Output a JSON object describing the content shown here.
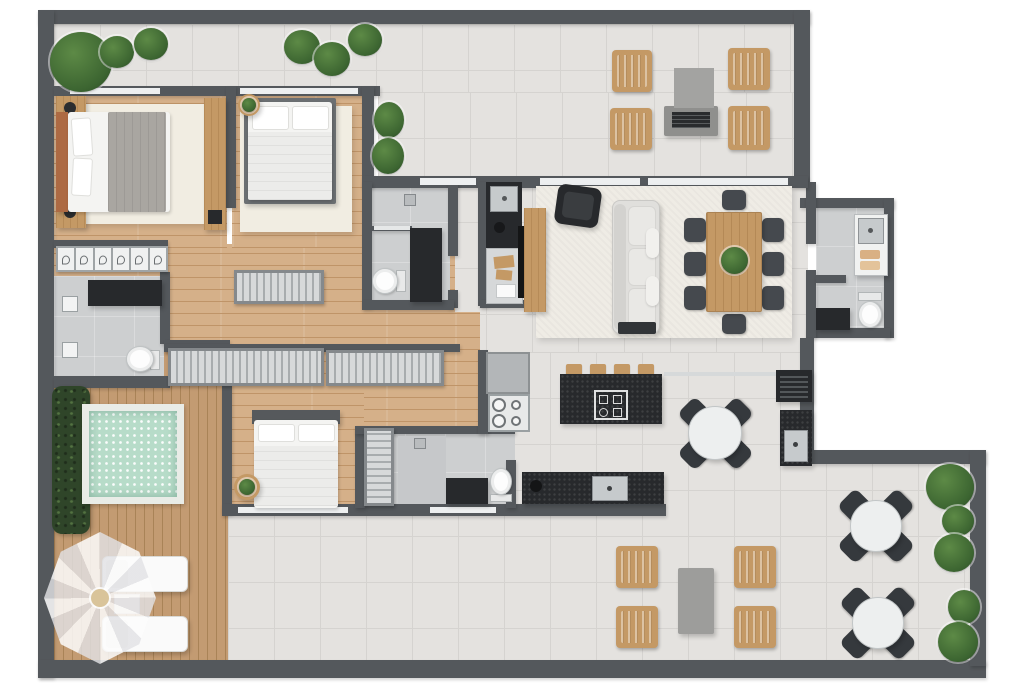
{
  "title": "apartment-floor-plan-top-view",
  "palette": {
    "outside": "#ffffff",
    "wall": "#54585c",
    "tile": "#e4e2df",
    "tile_line": "#d5d3d0",
    "bath_tile": "#cdcfd0",
    "wood": "#d5b089",
    "wood_line": "#bf9468",
    "deck": "#c39b72",
    "deck_line": "#a98357",
    "rug": "#f1ede2",
    "rug_living": "#efece5",
    "furn_dark": "#27292c",
    "wood_furn": "#c49965",
    "chair_dark": "#45494e",
    "sofa": "#e0dfdc",
    "sofa_base": "#323538",
    "steel": "#c6cacc",
    "glass": "#edeff0",
    "pool": "#b7dcc9",
    "hedge": "#2f4529",
    "plant": "#3c6531",
    "plant_light": "#5d8a46",
    "fire_table": "#a3a3a1",
    "fire_base": "#8f8f8d",
    "towel": "#d9b084",
    "headboard": "#ad6a43",
    "blanket": "#a9a6a1"
  },
  "inventory": {
    "rooms": [
      "top-balcony-terrace",
      "bedroom-1",
      "bedroom-2",
      "bedroom-3",
      "ensuite-bathroom",
      "hall-bathroom",
      "guest-bathroom",
      "laundry-wc",
      "walk-in-closet-hall",
      "kitchen",
      "living-room",
      "dining-area",
      "gourmet-terrace-kitchen",
      "pool-deck",
      "bottom-terrace"
    ],
    "furniture_counts": {
      "beds": 3,
      "sofas": 1,
      "armchairs": 1,
      "dining_chairs": 8,
      "dining_tables_rect": 1,
      "round_tables": 3,
      "round_table_chairs": 12,
      "wood_lounge_chairs": 8,
      "fire_pit_tables": 1,
      "outdoor_coffee_tables": 1,
      "sun_loungers": 2,
      "parasols": 1,
      "plunge_pools": 1,
      "toilets": 4,
      "showers": 2,
      "vanities": 4,
      "kitchen_islands": 1,
      "cooktops": 2,
      "bar_stools": 4,
      "refrigerators": 1,
      "grills": 1,
      "sinks": 4,
      "wardrobes": 4,
      "closet_modules": 6,
      "potted_plants": 16,
      "hedges": 1
    }
  }
}
